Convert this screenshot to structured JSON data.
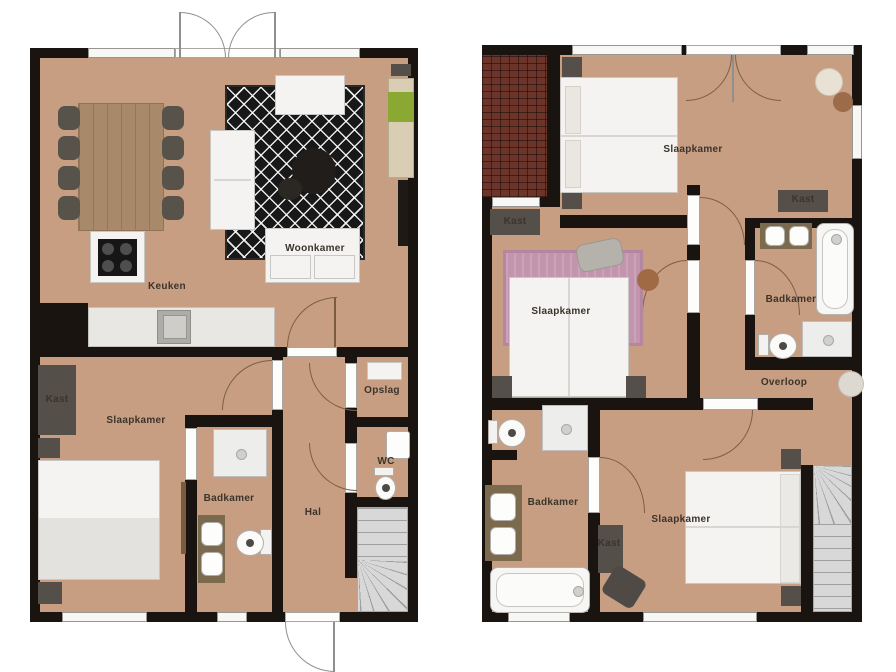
{
  "colors": {
    "floor": "#c79e82",
    "wall": "#19140f",
    "rug_dark": "#181818",
    "rug_pink": "#c394ad",
    "wood": "#a8896a",
    "roof_tiles": "#6d342a",
    "furniture_dark": "#544f48",
    "stairs": "#d8d8d8",
    "cabinet_green": "#8aa832"
  },
  "ground_floor": {
    "labels": {
      "keuken": "Keuken",
      "woonkamer": "Woonkamer",
      "kast": "Kast",
      "slaapkamer": "Slaapkamer",
      "badkamer": "Badkamer",
      "hal": "Hal",
      "opslag": "Opslag",
      "wc": "WC"
    }
  },
  "upper_floor": {
    "labels": {
      "slaapkamer_top": "Slaapkamer",
      "kast_left": "Kast",
      "kast_right": "Kast",
      "badkamer_top": "Badkamer",
      "overloop": "Overloop",
      "slaapkamer_mid": "Slaapkamer",
      "badkamer_bottom": "Badkamer",
      "kast_bottom": "Kast",
      "slaapkamer_bottom": "Slaapkamer"
    }
  }
}
